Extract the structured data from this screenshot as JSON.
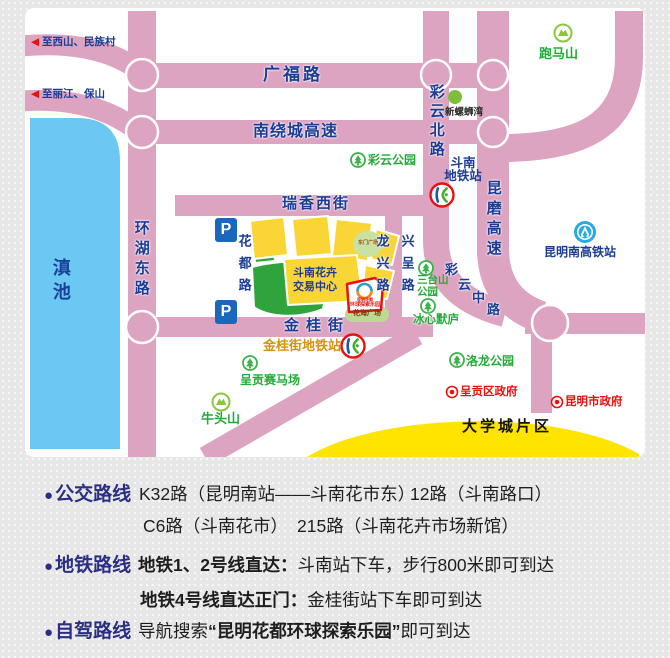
{
  "colors": {
    "road_pink": "#dda4c1",
    "lake_blue": "#6ac8f2",
    "building_yellow": "#f9d636",
    "area_green": "#2fa43d",
    "light_green": "#bcda92",
    "navy": "#1b3c94",
    "park_green": "#21ac38",
    "gov_red": "#e8110f",
    "metro_gold": "#d19310",
    "univ_yellow": "#ffe400"
  },
  "map": {
    "lake": "滇池",
    "exits": {
      "arrow": "◀",
      "to_xishan": "至西山、民族村",
      "to_lijiang": "至丽江、保山"
    },
    "roads": {
      "guangfu": "广福路",
      "nanraocheng": "南绕城高速",
      "caiyun_north": "彩云北路",
      "kunmo": "昆磨高速",
      "huanhu_east": "环湖东路",
      "ruixiang_west": "瑞香西街",
      "huadu": "花都路",
      "longxing": "龙兴路",
      "xingcheng": "兴呈路",
      "jingui": "金桂街",
      "caiyun_middle_chars": [
        "彩",
        "云",
        "中",
        "路"
      ]
    },
    "parking": "P",
    "pois": {
      "paomashan": "跑马山",
      "xinluosiwan": "新螺蛳湾",
      "caiyun_park": "彩云公园",
      "dounan_metro_l1": "斗南",
      "dounan_metro_l2": "地铁站",
      "market_l1": "斗南花卉",
      "market_l2": "交易中心",
      "santaishan_l1": "三台山",
      "santaishan_l2": "公园",
      "bingxin": "冰心默庐",
      "kunming_south_station": "昆明南高铁站",
      "jingui_metro": "金桂街地铁站",
      "saimachang": "呈贡赛马场",
      "niutoushan": "牛头山",
      "luolong_park": "洛龙公园",
      "chenggong_gov": "呈贡区政府",
      "kunming_gov": "昆明市政府",
      "university_town": "大学城片区",
      "huahai_square": "花海广场",
      "dongmen_square": "东门广场",
      "logo_l1": "昆明花都",
      "logo_l2": "环球探索乐园"
    }
  },
  "directions": {
    "bus": {
      "bullet": "●",
      "label": "公交路线",
      "route1": "K32路（昆明南站——斗南花市东）",
      "route2": "12路（斗南路口）",
      "route3": "C6路（斗南花市）",
      "route4": "215路（斗南花卉市场新馆）"
    },
    "metro": {
      "bullet": "●",
      "label": "地铁路线",
      "l1_head": "地铁1、2号线直达：",
      "l1_body": "斗南站下车，步行800米即可到达",
      "l2_head": "地铁4号线直达正门：",
      "l2_body": "金桂街站下车即可到达"
    },
    "drive": {
      "bullet": "●",
      "label": "自驾路线",
      "text_head": "导航搜索",
      "text_quote": "“昆明花都环球探索乐园”",
      "text_tail": "即可到达"
    }
  }
}
